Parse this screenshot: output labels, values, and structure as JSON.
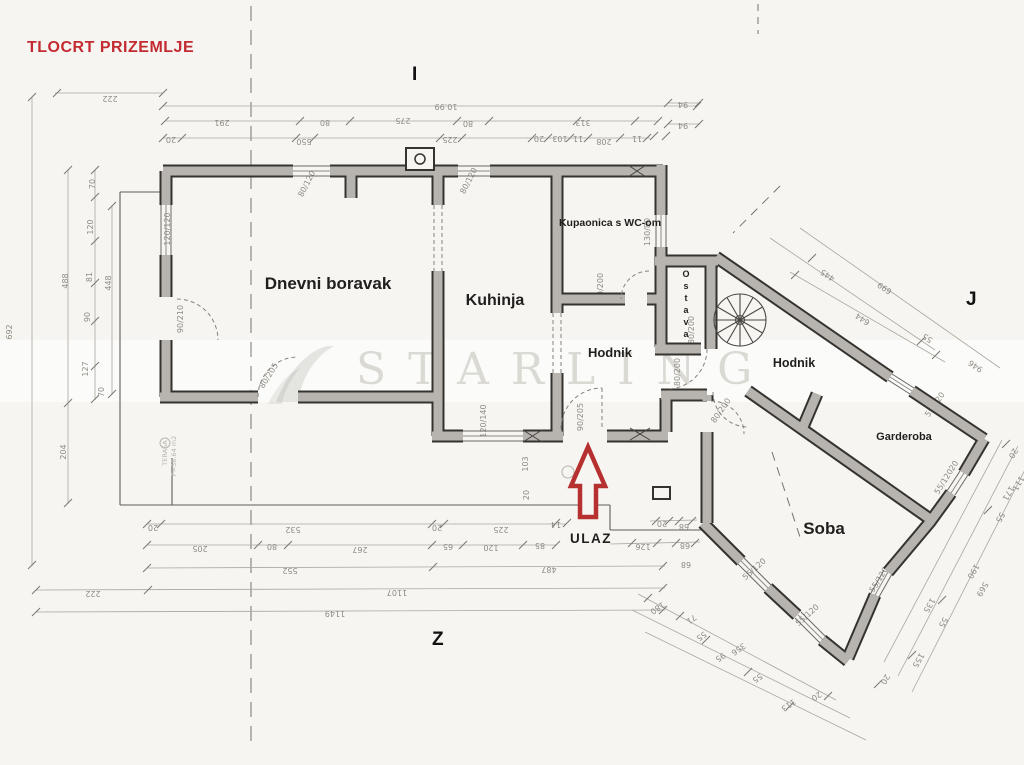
{
  "title": "TLOCRT PRIZEMLJE",
  "axes": {
    "i": "I",
    "j": "J",
    "z": "Z"
  },
  "rooms": {
    "living": "Dnevni boravak",
    "kitchen": "Kuhinja",
    "bath": "Kupaonica s WC-om",
    "hall1": "Hodnik",
    "hall2": "Hodnik",
    "pantry": "Ostava",
    "wardrobe": "Garderoba",
    "bedroom": "Soba",
    "entrance": "ULAZ"
  },
  "watermark": {
    "text": "STARLING"
  },
  "colors": {
    "paper": "#f6f5f2",
    "wall_fill": "#b7b4af",
    "wall_edge": "#35332f",
    "title_red": "#c32b31",
    "arrow_red": "#b5302e",
    "dim_text": "#8e8b83"
  },
  "plan": {
    "dims": [
      [
        "222",
        110,
        96,
        180
      ],
      [
        "10.99",
        446,
        104,
        180
      ],
      [
        "291",
        222,
        120,
        180
      ],
      [
        "80",
        325,
        120,
        180
      ],
      [
        "275",
        403,
        118,
        180
      ],
      [
        "80",
        468,
        121,
        180
      ],
      [
        "313",
        583,
        120,
        180
      ],
      [
        "94",
        683,
        102,
        180
      ],
      [
        "94",
        683,
        123,
        180
      ],
      [
        "20",
        171,
        137,
        180
      ],
      [
        "550",
        304,
        139,
        180
      ],
      [
        "225",
        450,
        137,
        180
      ],
      [
        "20",
        539,
        136,
        180
      ],
      [
        "103",
        560,
        136,
        180
      ],
      [
        "11",
        578,
        136,
        180
      ],
      [
        "208",
        604,
        139,
        180
      ],
      [
        "11",
        637,
        136,
        180
      ],
      [
        "692",
        12,
        332,
        -90
      ],
      [
        "488",
        68,
        281,
        -90
      ],
      [
        "204",
        66,
        452,
        -90
      ],
      [
        "70",
        95,
        184,
        -90
      ],
      [
        "120",
        93,
        227,
        -90
      ],
      [
        "81",
        92,
        277,
        -90
      ],
      [
        "90",
        90,
        317,
        -90
      ],
      [
        "127",
        88,
        369,
        -90
      ],
      [
        "70",
        104,
        392,
        -90
      ],
      [
        "448",
        111,
        283,
        -90
      ],
      [
        "120/120",
        170,
        229,
        -90
      ],
      [
        "90/210",
        183,
        319,
        -90
      ],
      [
        "80/120",
        309,
        185,
        -63
      ],
      [
        "80/120",
        471,
        182,
        -63
      ],
      [
        "130/80",
        650,
        232,
        -90
      ],
      [
        "70/200",
        603,
        287,
        -90
      ],
      [
        "120/140",
        486,
        421,
        -90
      ],
      [
        "90/205",
        583,
        417,
        -90
      ],
      [
        "80/205",
        271,
        377,
        -58
      ],
      [
        "80/200",
        680,
        372,
        -90
      ],
      [
        "80/200",
        694,
        330,
        -90
      ],
      [
        "80/200",
        723,
        412,
        -55
      ],
      [
        "55/120",
        937,
        406,
        -55
      ],
      [
        "55/120",
        946,
        483,
        -58
      ],
      [
        "20",
        956,
        467,
        -58
      ],
      [
        "55/120",
        881,
        581,
        -58
      ],
      [
        "20",
        894,
        566,
        -58
      ],
      [
        "55/120",
        756,
        571,
        -42
      ],
      [
        "55/120",
        809,
        617,
        -42
      ],
      [
        "103",
        528,
        464,
        -90
      ],
      [
        "20",
        529,
        495,
        -90
      ],
      [
        "20",
        153,
        525,
        180
      ],
      [
        "532",
        293,
        527,
        180
      ],
      [
        "20",
        437,
        525,
        180
      ],
      [
        "225",
        501,
        527,
        180
      ],
      [
        "14",
        556,
        522,
        180
      ],
      [
        "20",
        662,
        521,
        180
      ],
      [
        "68",
        684,
        524,
        180
      ],
      [
        "205",
        200,
        546,
        180
      ],
      [
        "80",
        272,
        544,
        180
      ],
      [
        "267",
        360,
        547,
        180
      ],
      [
        "65",
        448,
        544,
        180
      ],
      [
        "120",
        491,
        545,
        180
      ],
      [
        "85",
        540,
        543,
        180
      ],
      [
        "126",
        643,
        544,
        180
      ],
      [
        "68",
        685,
        543,
        180
      ],
      [
        "552",
        290,
        568,
        180
      ],
      [
        "487",
        549,
        567,
        180
      ],
      [
        "68",
        686,
        562,
        180
      ],
      [
        "222",
        93,
        591,
        180
      ],
      [
        "1107",
        397,
        590,
        180
      ],
      [
        "1149",
        335,
        611,
        180
      ],
      [
        "180",
        656,
        606,
        145
      ],
      [
        "71",
        690,
        617,
        145
      ],
      [
        "55",
        700,
        634,
        145
      ],
      [
        "95",
        719,
        655,
        145
      ],
      [
        "55",
        756,
        676,
        145
      ],
      [
        "356",
        737,
        647,
        145
      ],
      [
        "113",
        787,
        703,
        145
      ],
      [
        "20",
        815,
        694,
        145
      ],
      [
        "20",
        1011,
        452,
        120
      ],
      [
        "111",
        1016,
        482,
        120
      ],
      [
        "171",
        1006,
        492,
        120
      ],
      [
        "55",
        998,
        516,
        120
      ],
      [
        "190",
        971,
        570,
        120
      ],
      [
        "569",
        980,
        588,
        120
      ],
      [
        "135",
        927,
        604,
        120
      ],
      [
        "55",
        941,
        621,
        120
      ],
      [
        "155",
        916,
        659,
        120
      ],
      [
        "20",
        883,
        678,
        120
      ],
      [
        "445",
        829,
        273,
        -146
      ],
      [
        "699",
        886,
        286,
        -146
      ],
      [
        "644",
        864,
        317,
        -146
      ],
      [
        "55",
        929,
        336,
        -146
      ],
      [
        "946",
        977,
        364,
        -146
      ]
    ],
    "faint": [
      [
        "TERASA",
        167,
        453,
        -90
      ],
      [
        "P=38,64 m2",
        176,
        456,
        -90
      ]
    ],
    "ticks": [
      [
        57,
        93
      ],
      [
        163,
        93
      ],
      [
        163,
        106
      ],
      [
        697,
        106
      ],
      [
        165,
        121
      ],
      [
        300,
        121
      ],
      [
        350,
        121
      ],
      [
        457,
        121
      ],
      [
        489,
        121
      ],
      [
        577,
        121
      ],
      [
        635,
        121
      ],
      [
        658,
        121
      ],
      [
        163,
        138
      ],
      [
        182,
        138
      ],
      [
        296,
        138
      ],
      [
        314,
        138
      ],
      [
        440,
        138
      ],
      [
        462,
        138
      ],
      [
        532,
        138
      ],
      [
        548,
        138
      ],
      [
        570,
        138
      ],
      [
        588,
        138
      ],
      [
        620,
        138
      ],
      [
        647,
        138
      ],
      [
        668,
        103
      ],
      [
        699,
        103
      ],
      [
        668,
        124
      ],
      [
        699,
        124
      ],
      [
        654,
        136
      ],
      [
        666,
        136
      ],
      [
        32,
        97
      ],
      [
        32,
        565
      ],
      [
        68,
        170
      ],
      [
        68,
        403
      ],
      [
        68,
        503
      ],
      [
        95,
        170
      ],
      [
        95,
        197
      ],
      [
        95,
        241
      ],
      [
        95,
        283
      ],
      [
        95,
        321
      ],
      [
        95,
        366
      ],
      [
        95,
        399
      ],
      [
        112,
        206
      ],
      [
        112,
        394
      ],
      [
        147,
        524
      ],
      [
        161,
        524
      ],
      [
        432,
        524
      ],
      [
        444,
        524
      ],
      [
        556,
        523
      ],
      [
        567,
        523
      ],
      [
        656,
        521
      ],
      [
        669,
        521
      ],
      [
        679,
        521
      ],
      [
        692,
        521
      ],
      [
        147,
        545
      ],
      [
        258,
        545
      ],
      [
        288,
        545
      ],
      [
        432,
        545
      ],
      [
        463,
        545
      ],
      [
        523,
        545
      ],
      [
        556,
        545
      ],
      [
        632,
        543
      ],
      [
        657,
        543
      ],
      [
        676,
        543
      ],
      [
        695,
        543
      ],
      [
        147,
        568
      ],
      [
        433,
        567
      ],
      [
        663,
        566
      ],
      [
        36,
        590
      ],
      [
        148,
        590
      ],
      [
        663,
        588
      ],
      [
        36,
        612
      ],
      [
        663,
        610
      ],
      [
        812,
        258
      ],
      [
        921,
        341
      ],
      [
        795,
        275
      ],
      [
        936,
        355
      ],
      [
        1006,
        444
      ],
      [
        988,
        510
      ],
      [
        942,
        600
      ],
      [
        912,
        655
      ],
      [
        878,
        684
      ],
      [
        648,
        598
      ],
      [
        680,
        616
      ],
      [
        706,
        640
      ],
      [
        748,
        672
      ],
      [
        790,
        706
      ],
      [
        828,
        696
      ]
    ],
    "chains": [
      [
        55,
        93,
        163,
        93
      ],
      [
        163,
        106,
        698,
        106
      ],
      [
        165,
        121,
        659,
        121
      ],
      [
        163,
        138,
        650,
        138
      ],
      [
        668,
        103,
        700,
        103
      ],
      [
        668,
        124,
        700,
        124
      ],
      [
        32,
        97,
        32,
        566
      ],
      [
        68,
        170,
        68,
        504
      ],
      [
        95,
        170,
        95,
        400
      ],
      [
        112,
        206,
        112,
        395
      ],
      [
        147,
        524,
        566,
        524
      ],
      [
        650,
        521,
        697,
        520
      ],
      [
        147,
        545,
        557,
        545
      ],
      [
        610,
        544,
        700,
        542
      ],
      [
        147,
        568,
        665,
        566
      ],
      [
        36,
        590,
        665,
        588
      ],
      [
        36,
        612,
        665,
        610
      ],
      [
        770,
        238,
        935,
        350
      ],
      [
        800,
        228,
        1000,
        368
      ],
      [
        790,
        272,
        945,
        362
      ],
      [
        1002,
        440,
        884,
        662
      ],
      [
        1018,
        446,
        898,
        676
      ],
      [
        1034,
        452,
        912,
        692
      ],
      [
        638,
        594,
        836,
        700
      ],
      [
        632,
        610,
        850,
        718
      ],
      [
        645,
        632,
        866,
        740
      ]
    ]
  }
}
